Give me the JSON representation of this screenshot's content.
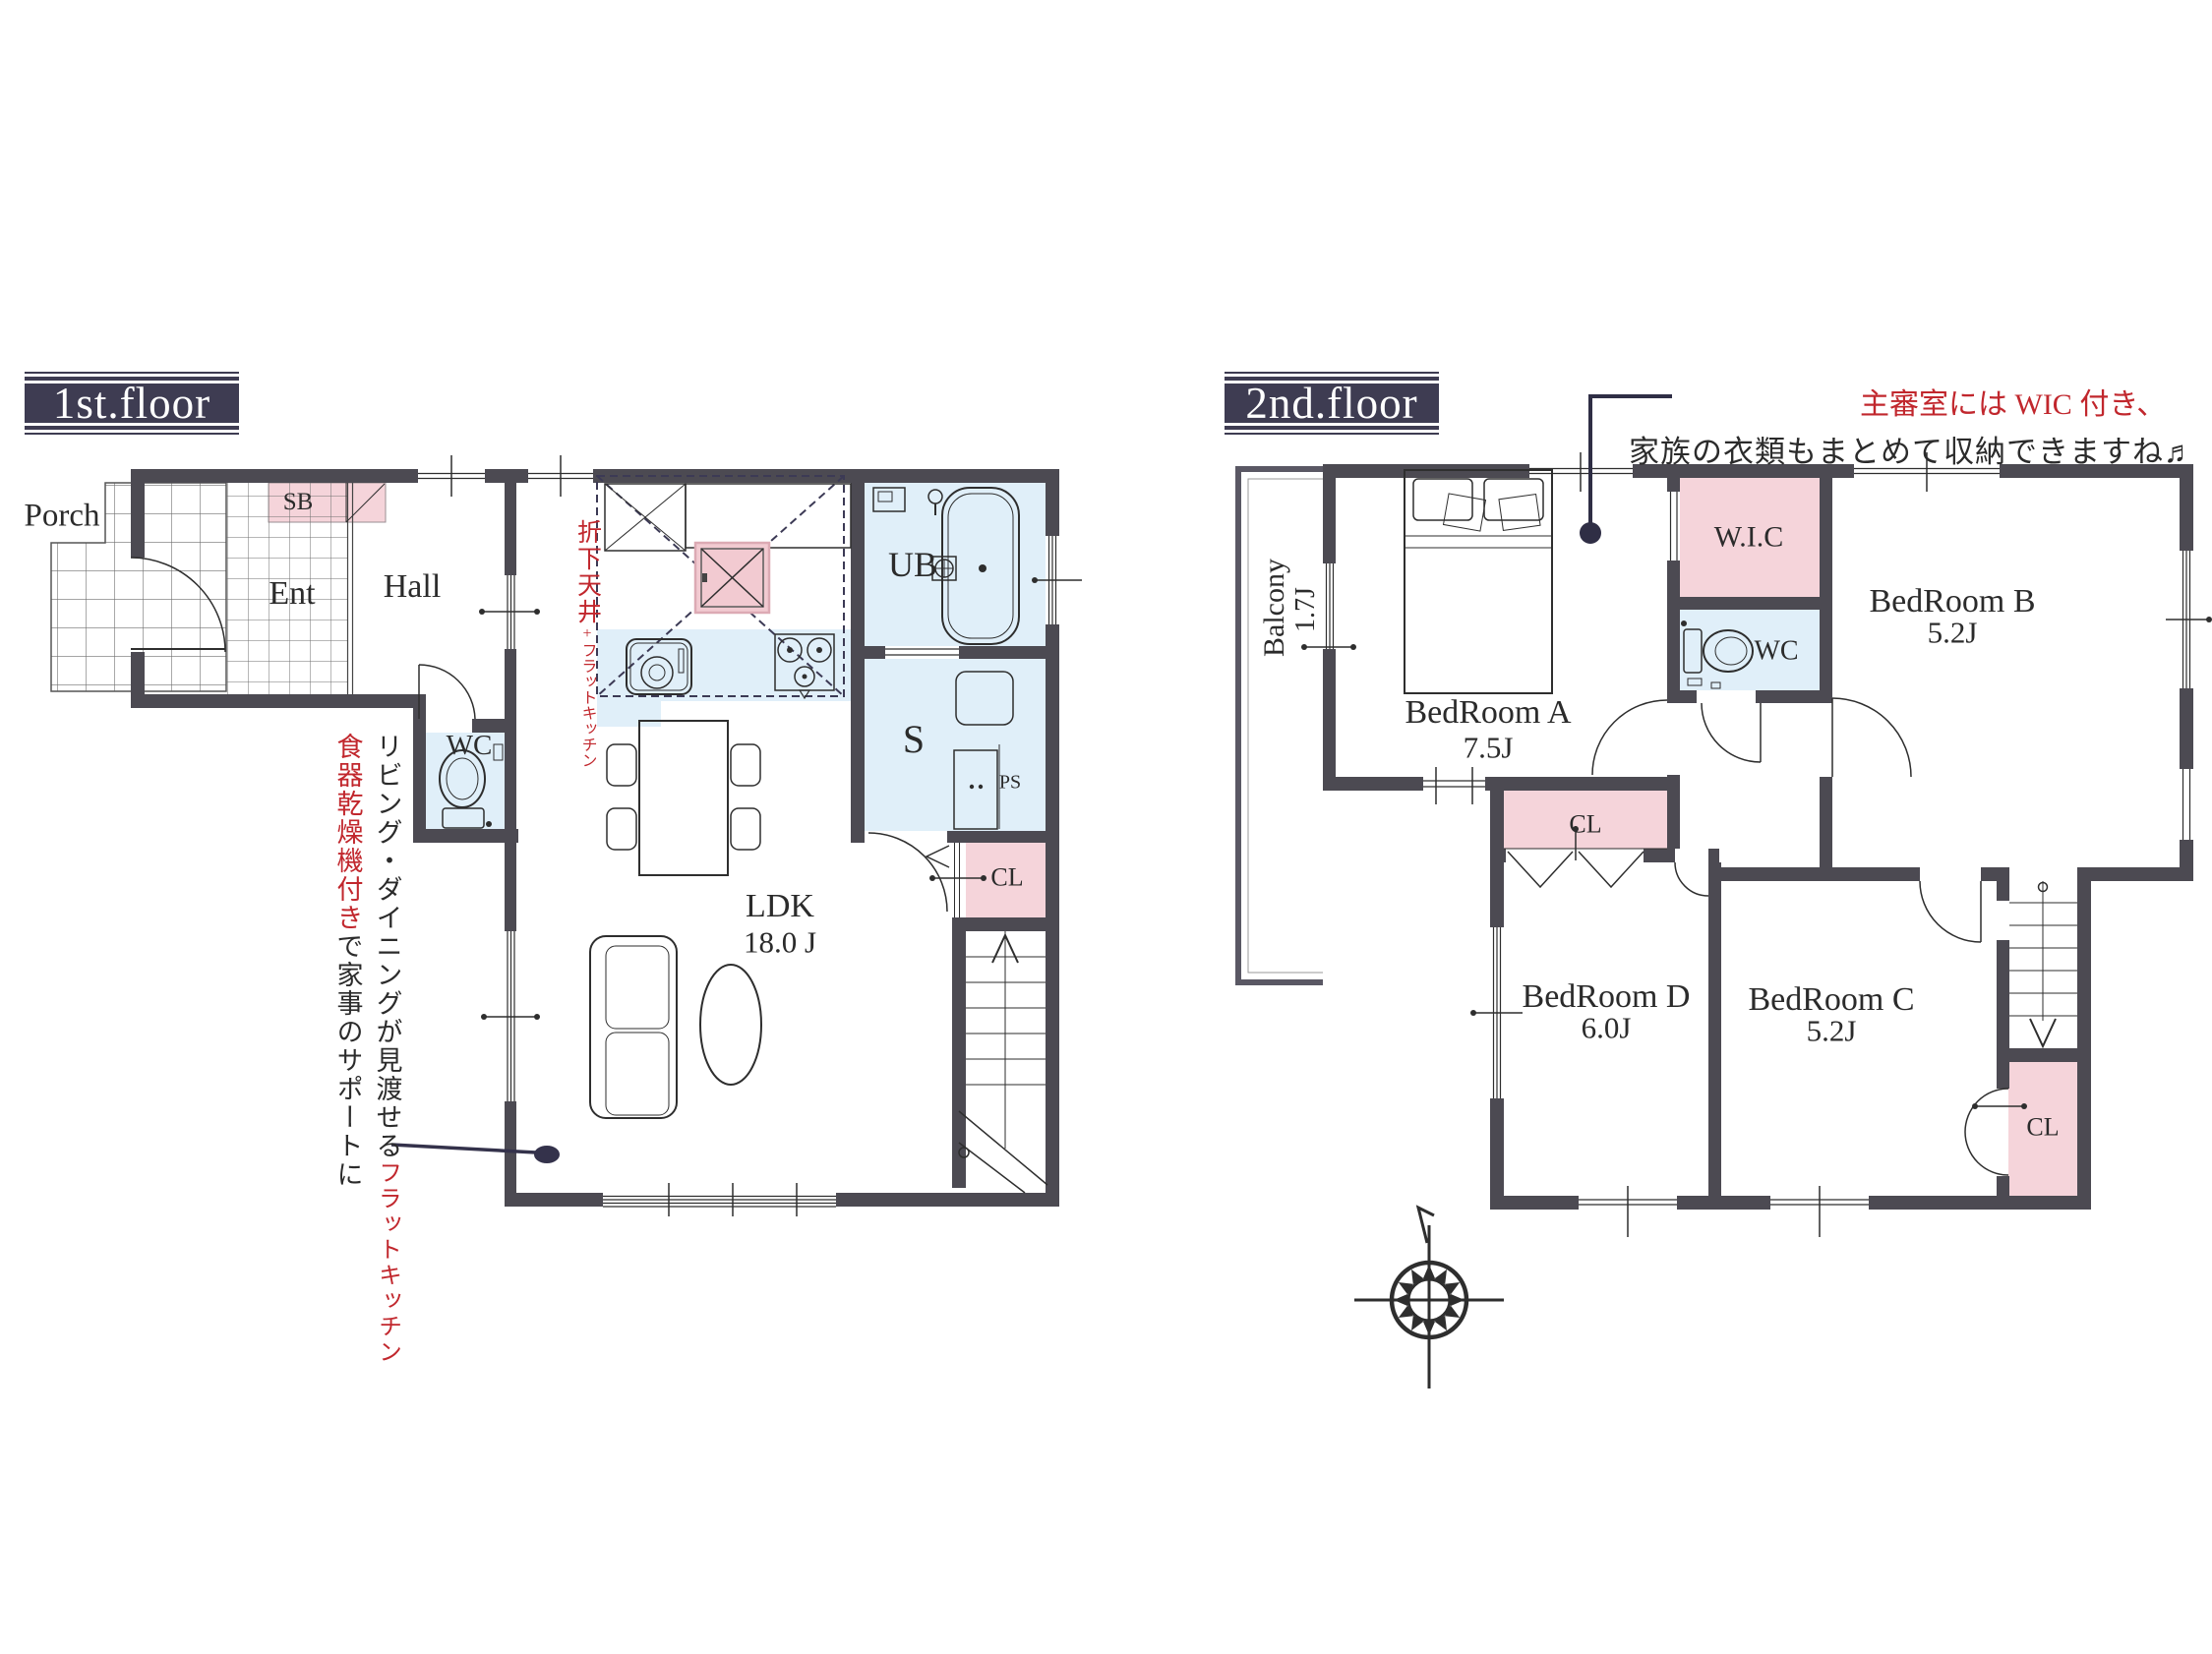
{
  "colors": {
    "wall": "#4c4a52",
    "pink_fill": "#f5d4da",
    "blue_fill": "#e0eff9",
    "accent_red": "#c1272d",
    "navy": "#34324b"
  },
  "floor1": {
    "title": "1st.floor",
    "rooms": {
      "porch": "Porch",
      "ent": "Ent",
      "hall": "Hall",
      "shoe_box": "SB",
      "toilet": "WC",
      "bath": "UB",
      "storage": "S",
      "pipe_space": "PS",
      "closet": "CL",
      "ldk_name": "LDK",
      "ldk_size": "18.0 J"
    },
    "kitchen_note": {
      "line1": "折下天井",
      "line2": "+フラットキッチン"
    },
    "side_note": {
      "col1_black": "リビング・ダイニングが見渡せる",
      "col1_red": "フラットキッチン",
      "col2_red": "食器乾燥機付き",
      "col2_black": "で家事のサポートに"
    }
  },
  "floor2": {
    "title": "2nd.floor",
    "note_red": "主審室には WIC 付き、",
    "note_black": "家族の衣類もまとめて収納できますね♬",
    "rooms": {
      "balcony_name": "Balcony",
      "balcony_size": "1.7J",
      "bedroom_a_name": "BedRoom A",
      "bedroom_a_size": "7.5J",
      "wic": "W.I.C",
      "toilet": "WC",
      "bedroom_b_name": "BedRoom B",
      "bedroom_b_size": "5.2J",
      "bedroom_c_name": "BedRoom C",
      "bedroom_c_size": "5.2J",
      "bedroom_d_name": "BedRoom D",
      "bedroom_d_size": "6.0J",
      "closet_mid": "CL",
      "closet_corner": "CL"
    }
  }
}
